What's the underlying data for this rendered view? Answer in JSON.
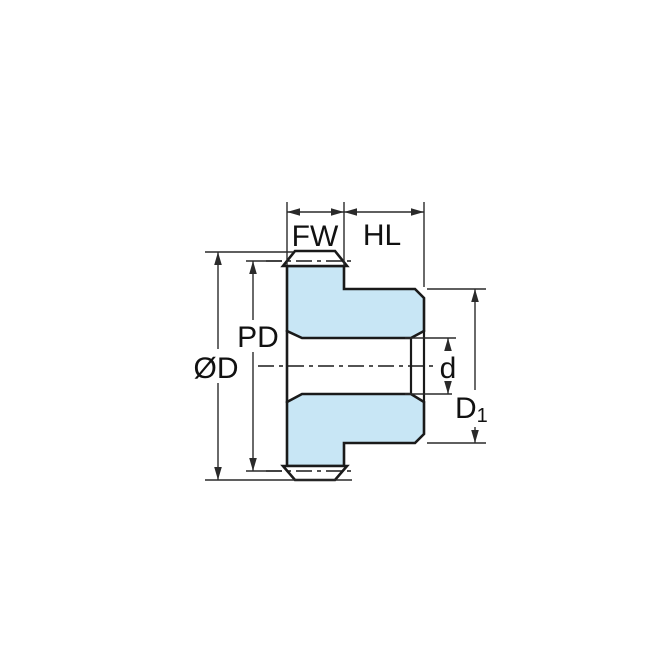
{
  "diagram": {
    "type": "engineering-drawing",
    "subject": "spur-gear-side-cross-section",
    "dimensions": {
      "face_width": {
        "label": "FW"
      },
      "hub_length": {
        "label": "HL"
      },
      "pitch_diameter": {
        "label": "PD"
      },
      "outside_diameter": {
        "label": "ØD"
      },
      "bore_diameter": {
        "label": "d"
      },
      "hub_diameter": {
        "label": "D",
        "subscript": "1"
      }
    },
    "colors": {
      "part_fill": "#C8E6F5",
      "outline": "#1A1A1A",
      "dimension_lines": "#2A2A2A",
      "background": "#FFFFFF"
    }
  }
}
